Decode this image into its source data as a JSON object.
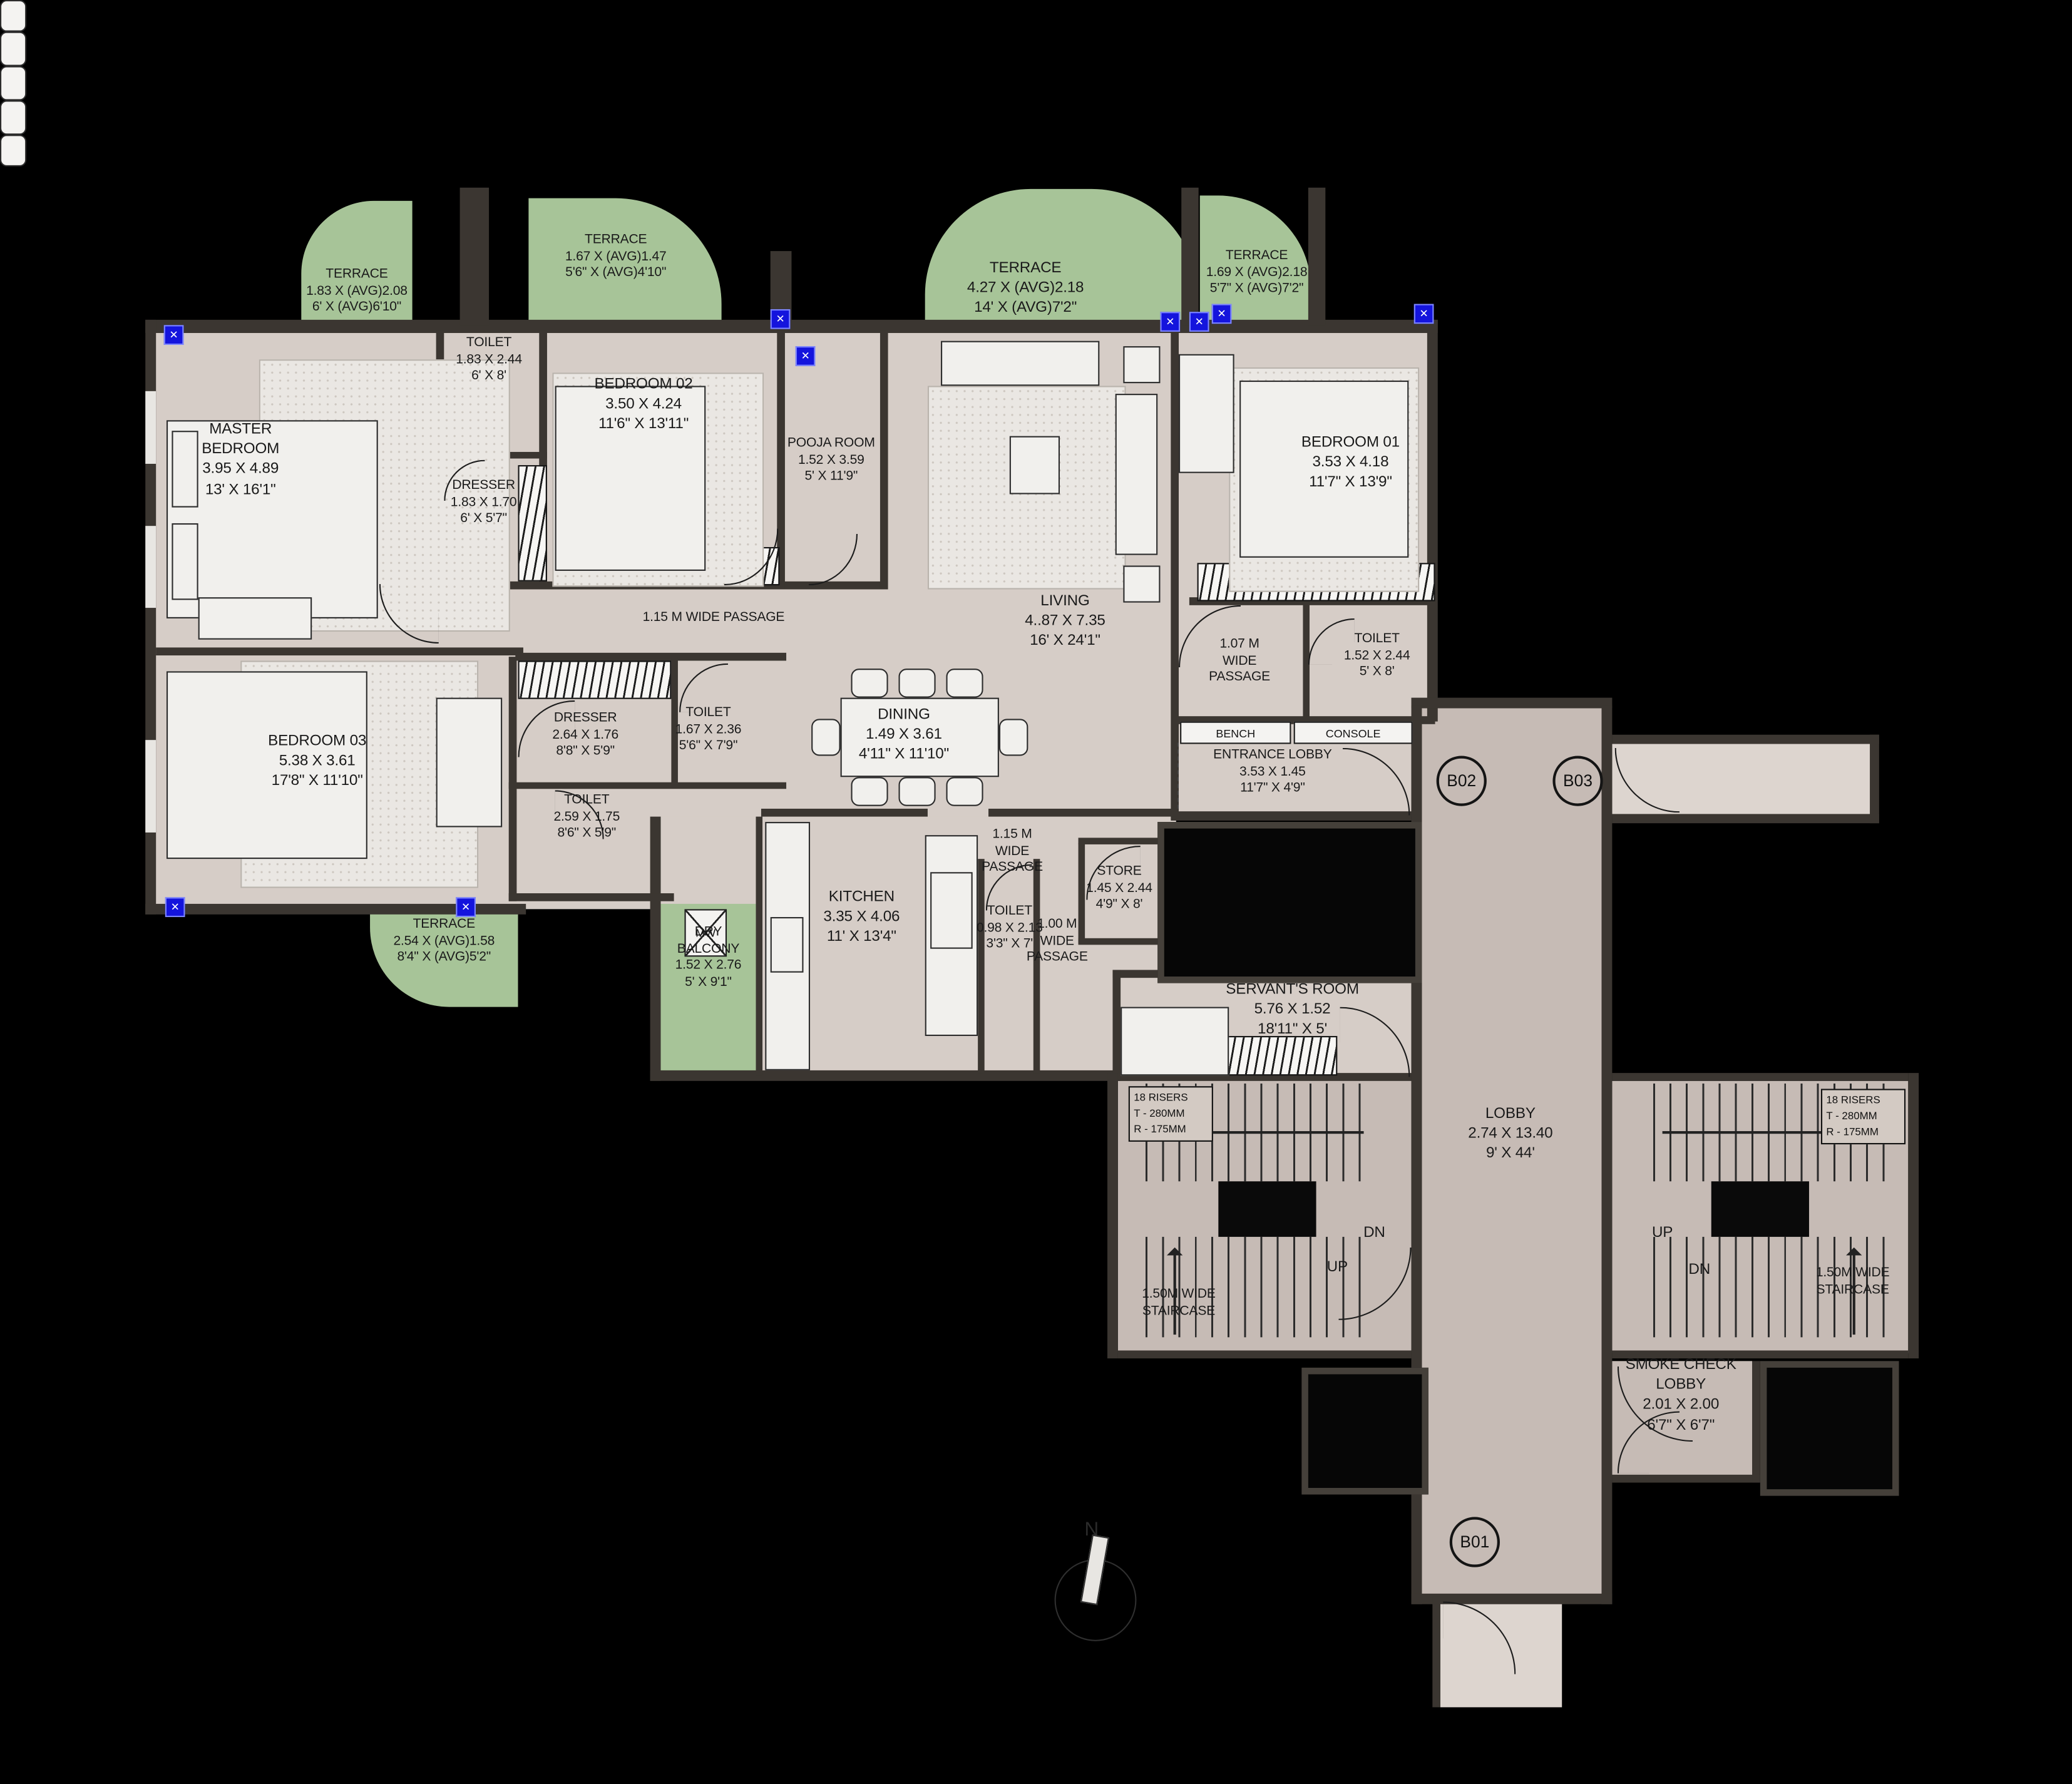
{
  "colors": {
    "floor": "#d6cdc7",
    "lobby_floor": "#c6bbb5",
    "terrace_green": "#a7c498",
    "wall": "#3b3631",
    "window_marker_blue": "#1414dd",
    "background": "#000000"
  },
  "rooms": [
    {
      "id": "master-bedroom",
      "lines": [
        "MASTER",
        "BEDROOM",
        "3.95 X 4.89",
        "13' X 16'1\""
      ]
    },
    {
      "id": "toilet-master",
      "lines": [
        "TOILET",
        "1.83 X 2.44",
        "6' X 8'"
      ]
    },
    {
      "id": "dresser-master",
      "lines": [
        "DRESSER",
        "1.83 X 1.70",
        "6' X 5'7\""
      ]
    },
    {
      "id": "bedroom-02",
      "lines": [
        "BEDROOM 02",
        "3.50 X 4.24",
        "11'6\" X 13'11\""
      ]
    },
    {
      "id": "pooja-room",
      "lines": [
        "POOJA ROOM",
        "1.52 X 3.59",
        "5' X 11'9\""
      ]
    },
    {
      "id": "living",
      "lines": [
        "LIVING",
        "4..87 X 7.35",
        "16' X 24'1\""
      ]
    },
    {
      "id": "dining",
      "lines": [
        "DINING",
        "1.49 X 3.61",
        "4'11\" X 11'10\""
      ]
    },
    {
      "id": "bedroom-01",
      "lines": [
        "BEDROOM 01",
        "3.53 X 4.18",
        "11'7\" X 13'9\""
      ]
    },
    {
      "id": "toilet-bedroom01",
      "lines": [
        "TOILET",
        "1.52 X 2.44",
        "5' X 8'"
      ]
    },
    {
      "id": "entrance-lobby",
      "lines": [
        "ENTRANCE LOBBY",
        "3.53 X 1.45",
        "11'7\" X 4'9\""
      ]
    },
    {
      "id": "dresser-2",
      "lines": [
        "DRESSER",
        "2.64 X 1.76",
        "8'8\" X 5'9\""
      ]
    },
    {
      "id": "toilet-center",
      "lines": [
        "TOILET",
        "1.67 X 2.36",
        "5'6\" X 7'9\""
      ]
    },
    {
      "id": "bedroom-03",
      "lines": [
        "BEDROOM 03",
        "5.38 X 3.61",
        "17'8\" X 11'10\""
      ]
    },
    {
      "id": "toilet-bedroom03",
      "lines": [
        "TOILET",
        "2.59 X 1.75",
        "8'6\" X 5'9\""
      ]
    },
    {
      "id": "kitchen",
      "lines": [
        "KITCHEN",
        "3.35 X 4.06",
        "11' X 13'4\""
      ]
    },
    {
      "id": "dry-balcony",
      "lines": [
        "DRY",
        "BALCONY",
        "1.52 X 2.76",
        "5' X 9'1\""
      ]
    },
    {
      "id": "toilet-kitchen",
      "lines": [
        "TOILET",
        "0.98 X 2.13",
        "3'3\" X 7'"
      ]
    },
    {
      "id": "store",
      "lines": [
        "STORE",
        "1.45 X 2.44",
        "4'9\" X 8'"
      ]
    },
    {
      "id": "servants-room",
      "lines": [
        "SERVANT'S ROOM",
        "5.76 X 1.52",
        "18'11\" X 5'"
      ]
    },
    {
      "id": "lobby",
      "lines": [
        "LOBBY",
        "2.74 X 13.40",
        "9' X 44'"
      ]
    },
    {
      "id": "smoke-check-lobby",
      "lines": [
        "SMOKE CHECK",
        "LOBBY",
        "2.01 X 2.00",
        "6'7\" X 6'7\""
      ]
    }
  ],
  "terraces": [
    {
      "id": "terrace-master",
      "lines": [
        "TERRACE",
        "1.83 X (AVG)2.08",
        "6' X (AVG)6'10\""
      ]
    },
    {
      "id": "terrace-bedroom02",
      "lines": [
        "TERRACE",
        "1.67 X (AVG)1.47",
        "5'6\" X (AVG)4'10\""
      ]
    },
    {
      "id": "terrace-living",
      "lines": [
        "TERRACE",
        "4.27 X (AVG)2.18",
        "14' X (AVG)7'2\""
      ]
    },
    {
      "id": "terrace-bedroom01",
      "lines": [
        "TERRACE",
        "1.69 X (AVG)2.18",
        "5'7\" X (AVG)7'2\""
      ]
    },
    {
      "id": "terrace-bedroom03",
      "lines": [
        "TERRACE",
        "2.54 X (AVG)1.58",
        "8'4\" X (AVG)5'2\""
      ]
    }
  ],
  "passages": [
    {
      "id": "passage-main",
      "lines": [
        "1.15 M WIDE PASSAGE"
      ]
    },
    {
      "id": "passage-107",
      "lines": [
        "1.07 M",
        "WIDE",
        "PASSAGE"
      ]
    },
    {
      "id": "passage-115-kitchen",
      "lines": [
        "1.15 M",
        "WIDE",
        "PASSAGE"
      ]
    },
    {
      "id": "passage-100",
      "lines": [
        "1.00 M",
        "WIDE",
        "PASSAGE"
      ]
    }
  ],
  "stairs": {
    "risers": [
      "18 RISERS",
      "T - 280MM",
      "R - 175MM"
    ],
    "up": "UP",
    "dn": "DN",
    "label": [
      "1.50M WIDE",
      "STAIRCASE"
    ]
  },
  "markers": {
    "b01": "B01",
    "b02": "B02",
    "b03": "B03"
  },
  "misc": {
    "bench": "BENCH",
    "console": "CONSOLE",
    "mw": "MW",
    "north": "N"
  }
}
